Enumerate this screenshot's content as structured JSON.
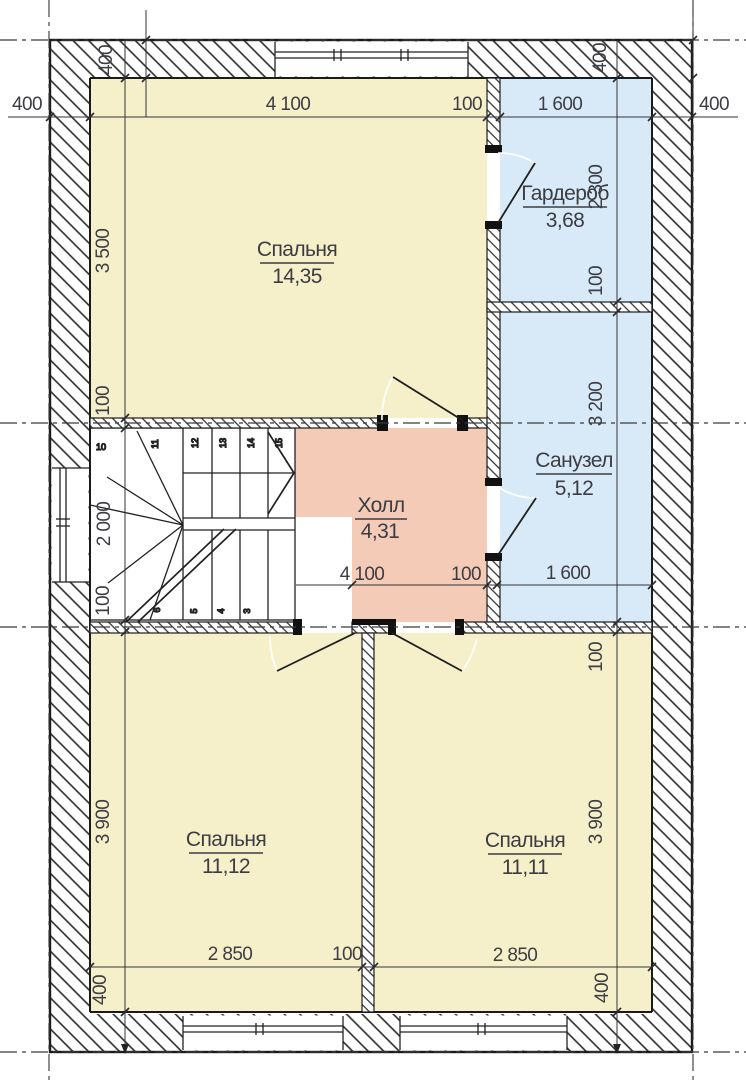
{
  "drawing": {
    "title": "floor-plan-second-floor",
    "colors": {
      "room_yellow": "#f6f0ca",
      "room_blue": "#d8eaf7",
      "room_salmon": "#f3cbb6",
      "wall_line": "#1b1b1b",
      "dim_text": "#3d3d44"
    },
    "rooms": [
      {
        "name": "Спальня",
        "area": "14,35",
        "fill": "yellow"
      },
      {
        "name": "Гардероб",
        "area": "3,68",
        "fill": "blue"
      },
      {
        "name": "Санузел",
        "area": "5,12",
        "fill": "blue"
      },
      {
        "name": "Холл",
        "area": "4,31",
        "fill": "salmon"
      },
      {
        "name": "Спальня",
        "area": "11,12",
        "fill": "yellow"
      },
      {
        "name": "Спальня",
        "area": "11,11",
        "fill": "yellow"
      }
    ],
    "dimensions": {
      "top": [
        "4 100",
        "100",
        "1 600"
      ],
      "middle": [
        "4 100",
        "100",
        "1 600"
      ],
      "bottom": [
        "2 850",
        "100",
        "2 850"
      ],
      "left": [
        "3 500",
        "100",
        "2 000",
        "100",
        "3 900",
        "400"
      ],
      "right": [
        "2 300",
        "100",
        "3 200",
        "100",
        "3 900",
        "400"
      ],
      "corners": {
        "top_left_v": "400",
        "top_left_h": "400",
        "top_right_v": "400",
        "top_right_h": "400"
      }
    },
    "stairs": {
      "upper_steps": [
        "10",
        "11",
        "12",
        "13",
        "14",
        "15"
      ],
      "lower_steps": [
        "6",
        "5",
        "4",
        "3"
      ]
    }
  }
}
